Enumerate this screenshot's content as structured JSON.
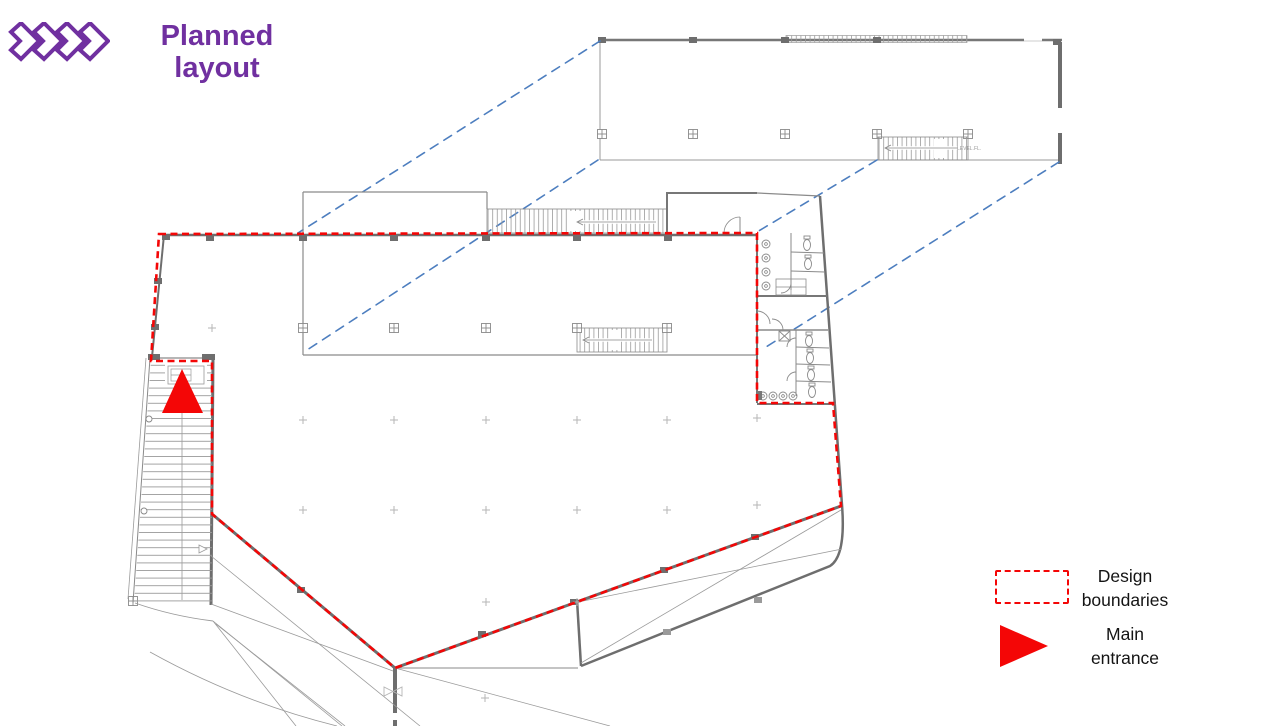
{
  "slide": {
    "title_full": "Planned layout",
    "title_lines": [
      "Planned",
      "layout"
    ],
    "accent_purple": "#7030a0"
  },
  "logo": {
    "icon": "chevron-diamonds",
    "count": 4,
    "color": "#7030a0"
  },
  "floorplan": {
    "stair_label": "LEVEL.FL.",
    "colors": {
      "wall_gray": "#6e6e6e",
      "detail_gray": "#9a9a9a",
      "boundary_red": "#f40606",
      "entrance_red": "#f40606",
      "projection_blue": "#4d7ebf"
    }
  },
  "legend": {
    "items": [
      {
        "symbol": "dashed-red-rectangle",
        "color": "#f40606",
        "label": "Design boundaries",
        "lines": [
          "Design",
          "boundaries"
        ]
      },
      {
        "symbol": "red-right-triangle",
        "color": "#f40606",
        "label": "Main entrance",
        "lines": [
          "Main",
          "entrance"
        ]
      }
    ]
  }
}
